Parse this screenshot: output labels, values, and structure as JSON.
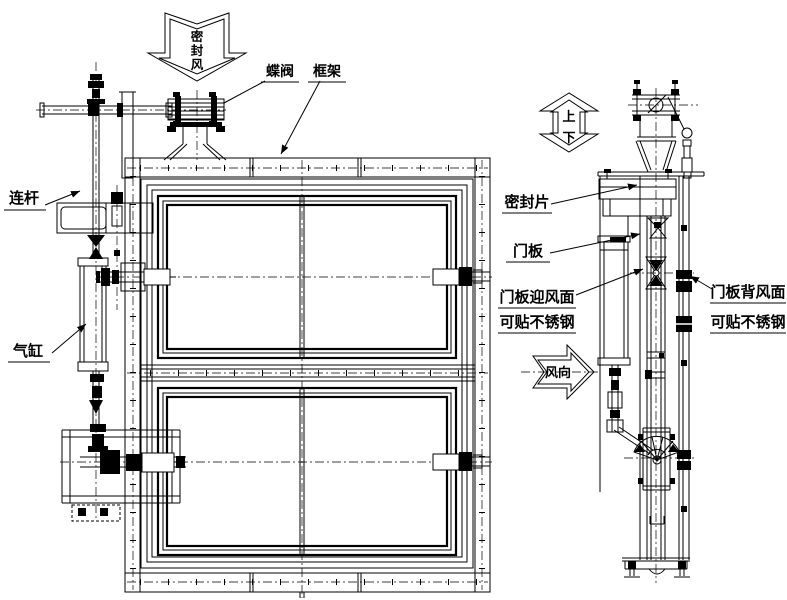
{
  "drawing": {
    "type": "engineering-cad-drawing",
    "subject": "sealed damper door assembly, front view and side view",
    "colors": {
      "line": "#000000",
      "background": "#ffffff"
    },
    "labels": {
      "seal_air": [
        "密",
        "封",
        "风"
      ],
      "butterfly_valve": "蝶阀",
      "frame": "框架",
      "connecting_rod": "连杆",
      "cylinder": "气缸",
      "seal_strip": "密封片",
      "door_panel": "门板",
      "windward_line1": "门板迎风面",
      "windward_line2": "可贴不锈钢",
      "leeward_line1": "门板背风面",
      "leeward_line2": "可贴不锈钢",
      "up": "上",
      "down": "下",
      "wind_direction": "风向"
    }
  }
}
